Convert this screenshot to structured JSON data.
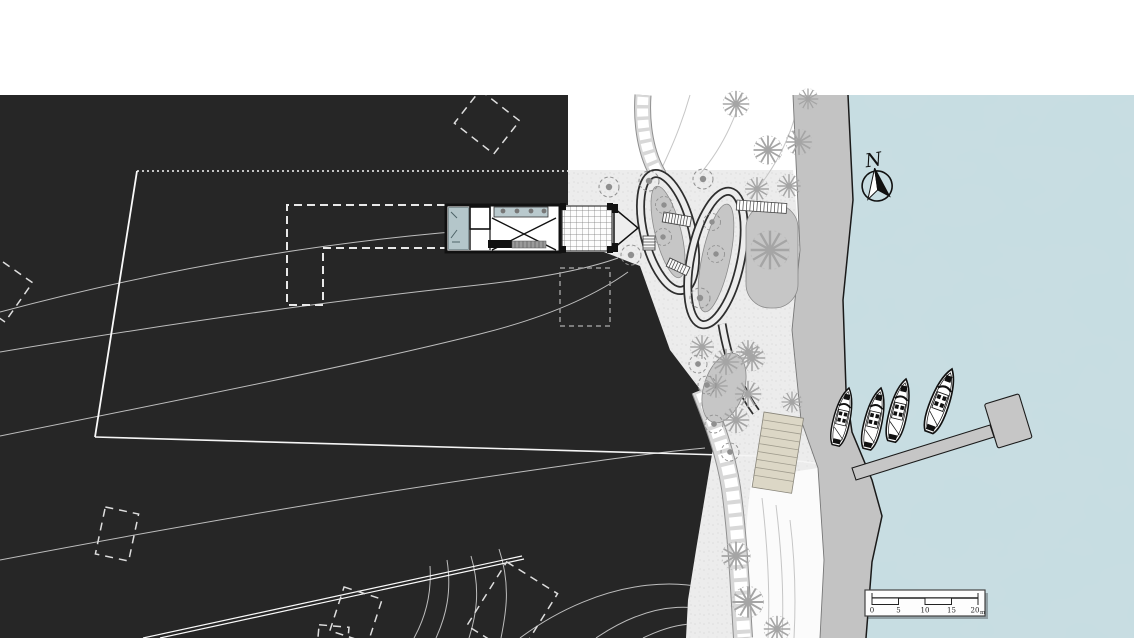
{
  "header": {
    "title": "ARCHICAD VERSION EDUCATION",
    "title_color": "#2b3990"
  },
  "plan": {
    "type": "architectural-site-plan",
    "north_arrow": {
      "label": "N"
    },
    "scale_bar": {
      "labels": [
        "0",
        "5",
        "10",
        "15",
        "20"
      ],
      "unit": "m"
    },
    "features": {
      "boats_count": 4,
      "marina_pier": "T-shaped dock",
      "building": "long pavilion with deck",
      "garden": "serpentine looped paths with planting beds",
      "terrain": "dark site plan with white contour lines"
    },
    "colors": {
      "terrain_dark": "#262626",
      "water": "#c9dde2",
      "promenade": "#c3c3c3",
      "garden_ground": "#ececec",
      "steps": "#dcd7c6",
      "contour_line": "#f5f5f5",
      "planting_bed": "#c6c6c6"
    }
  }
}
